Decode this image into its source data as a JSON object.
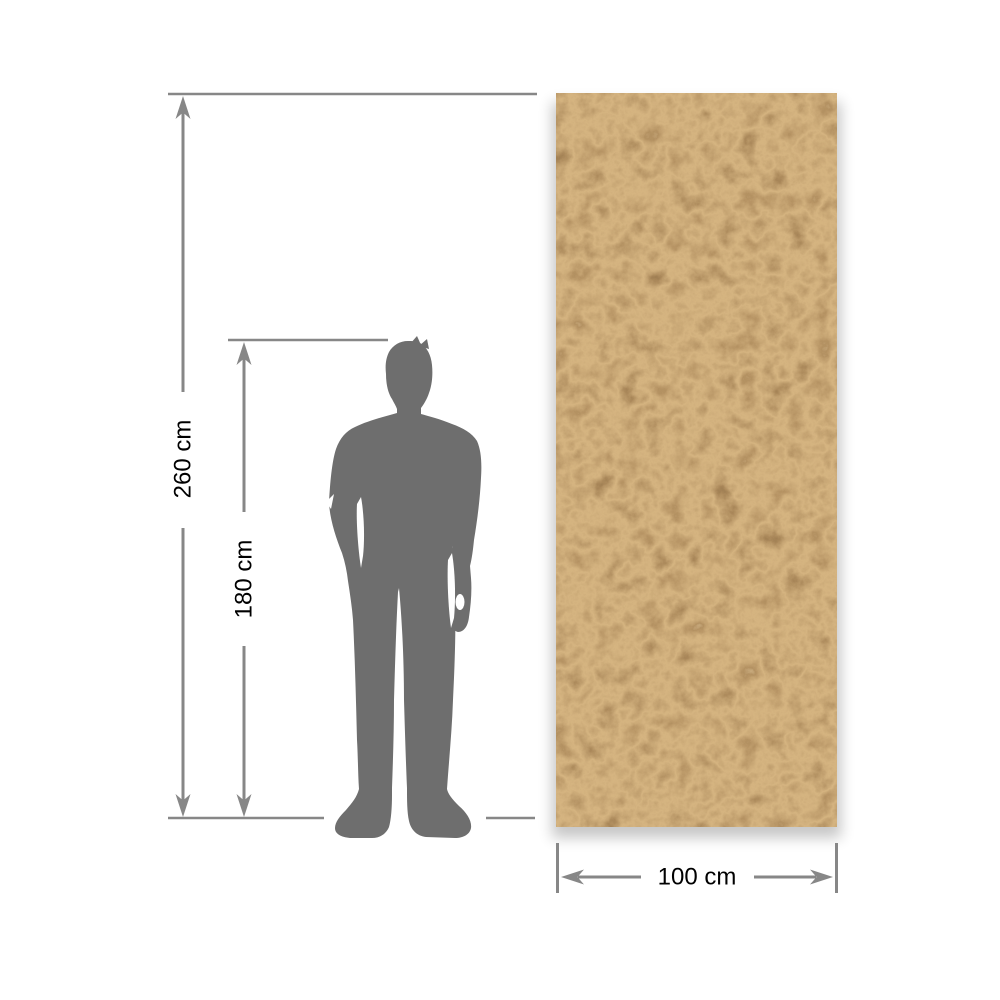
{
  "dimensions": {
    "total_height": {
      "label": "260 cm",
      "value": 260,
      "unit": "cm"
    },
    "person_height": {
      "label": "180 cm",
      "value": 180,
      "unit": "cm"
    },
    "panel_width": {
      "label": "100 cm",
      "value": 100,
      "unit": "cm"
    }
  },
  "colors": {
    "background": "#ffffff",
    "dimension_lines": "#878787",
    "labels": "#000000",
    "silhouette": "#6e6e6e",
    "panel_base": "#8a5a2e",
    "panel_dark": "#3f2a14",
    "panel_light": "#c79e69"
  },
  "icons": {
    "person": "person-silhouette",
    "panel": "textured-panel-swatch"
  }
}
